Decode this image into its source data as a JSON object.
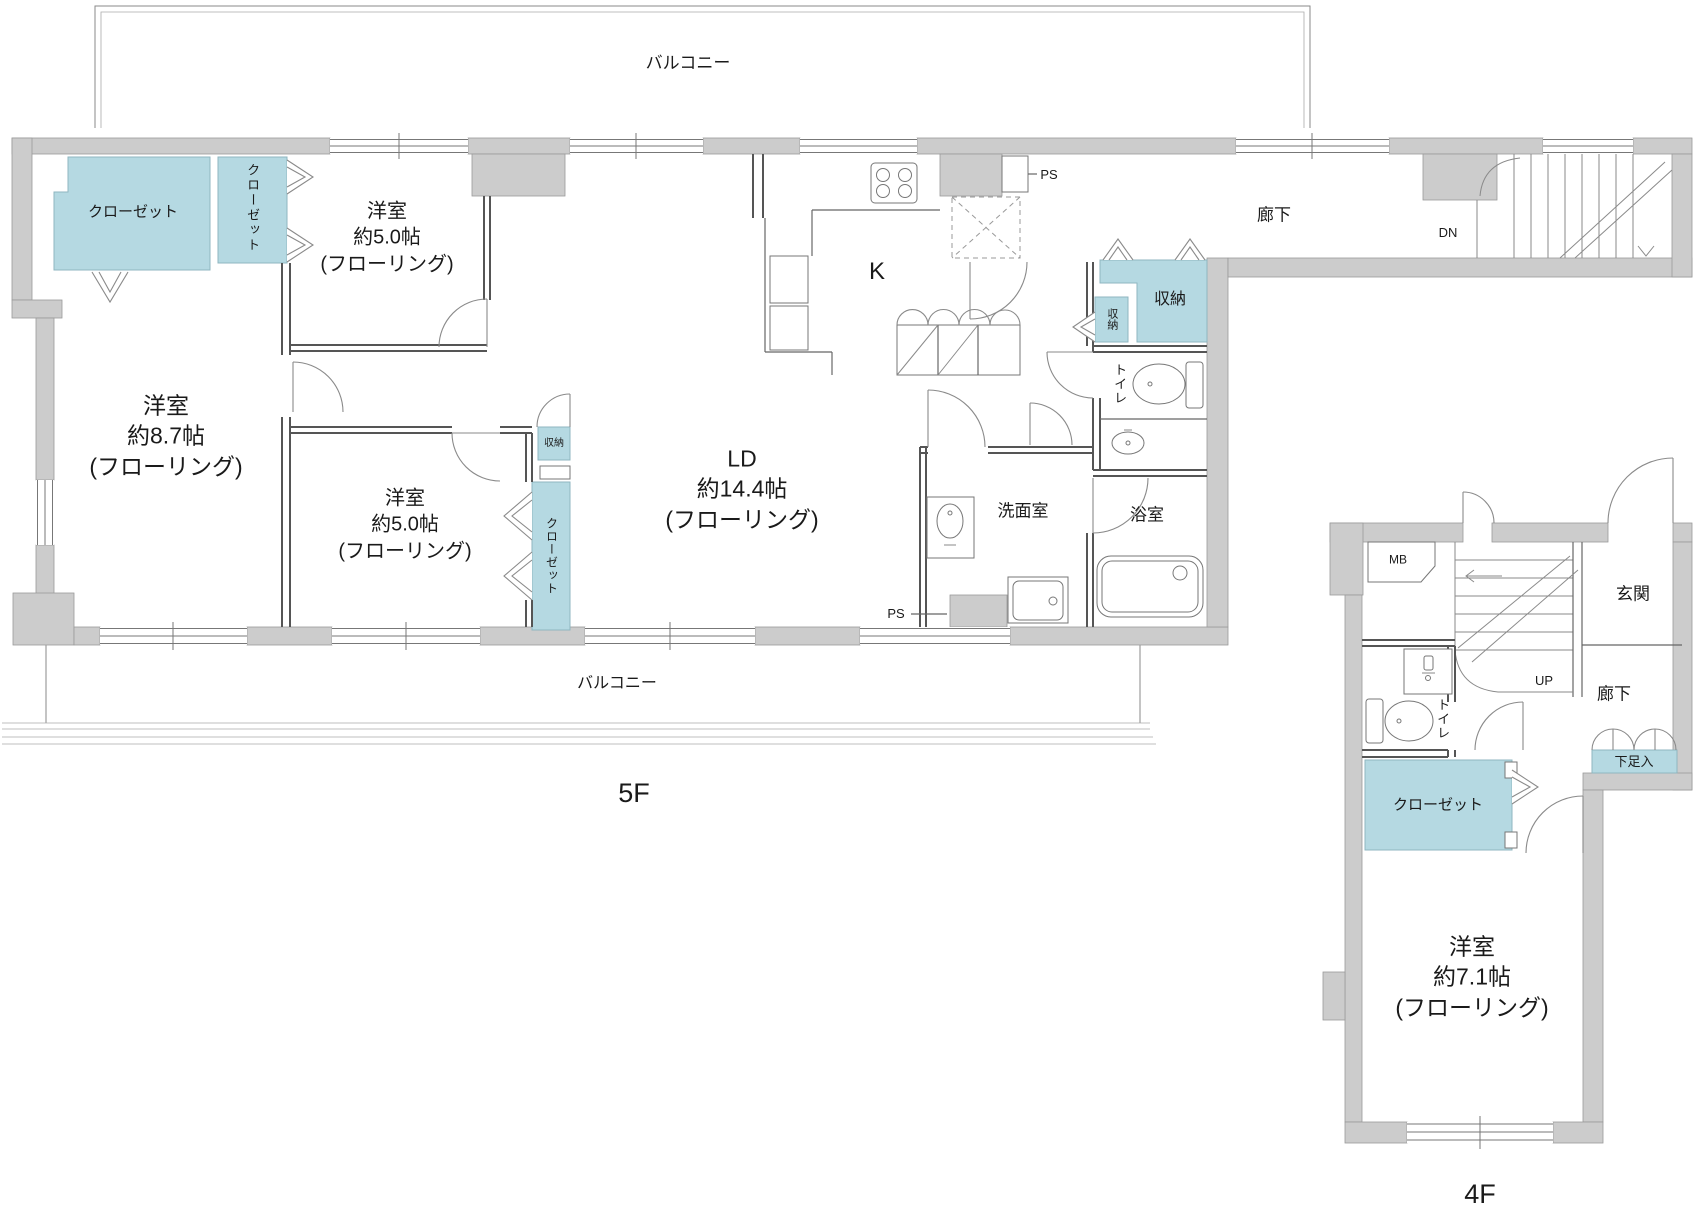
{
  "meta": {
    "drawing_type": "apartment floor plan (madori-zu)"
  },
  "colors": {
    "wall_fill": "#cccccc",
    "storage_fill": "#b5d9e2",
    "line": "#555555",
    "text": "#1a1a1a",
    "background": "#ffffff"
  },
  "floor5": {
    "floor_label": "5F",
    "balcony_top": "バルコニー",
    "balcony_bottom": "バルコニー",
    "rooms": {
      "bed1": {
        "name": "洋室",
        "size": "約5.0帖",
        "finish": "(フローリング)"
      },
      "bed2": {
        "name": "洋室",
        "size": "約8.7帖",
        "finish": "(フローリング)"
      },
      "bed3": {
        "name": "洋室",
        "size": "約5.0帖",
        "finish": "(フローリング)"
      },
      "ld": {
        "name": "LD",
        "size": "約14.4帖",
        "finish": "(フローリング)"
      },
      "kitchen": "K",
      "hallway": "廊下",
      "washroom": "洗面室",
      "bathroom": "浴室",
      "toilet": "トイレ"
    },
    "storage": {
      "closet1": "クローゼット",
      "closet2": "クローゼット",
      "closet_strip": "クローゼット",
      "shuno_mid": "収納",
      "shuno_big": "収納",
      "shuno_small": "収納"
    },
    "labels": {
      "ps_top": "PS",
      "ps_bottom": "PS",
      "dn": "DN"
    }
  },
  "floor4": {
    "floor_label": "4F",
    "rooms": {
      "bed": {
        "name": "洋室",
        "size": "約7.1帖",
        "finish": "(フローリング)"
      },
      "entrance": "玄関",
      "hallway": "廊下",
      "toilet": "トイレ"
    },
    "storage": {
      "closet": "クローゼット",
      "shoe_box": "下足入"
    },
    "labels": {
      "mb": "MB",
      "up": "UP"
    }
  }
}
